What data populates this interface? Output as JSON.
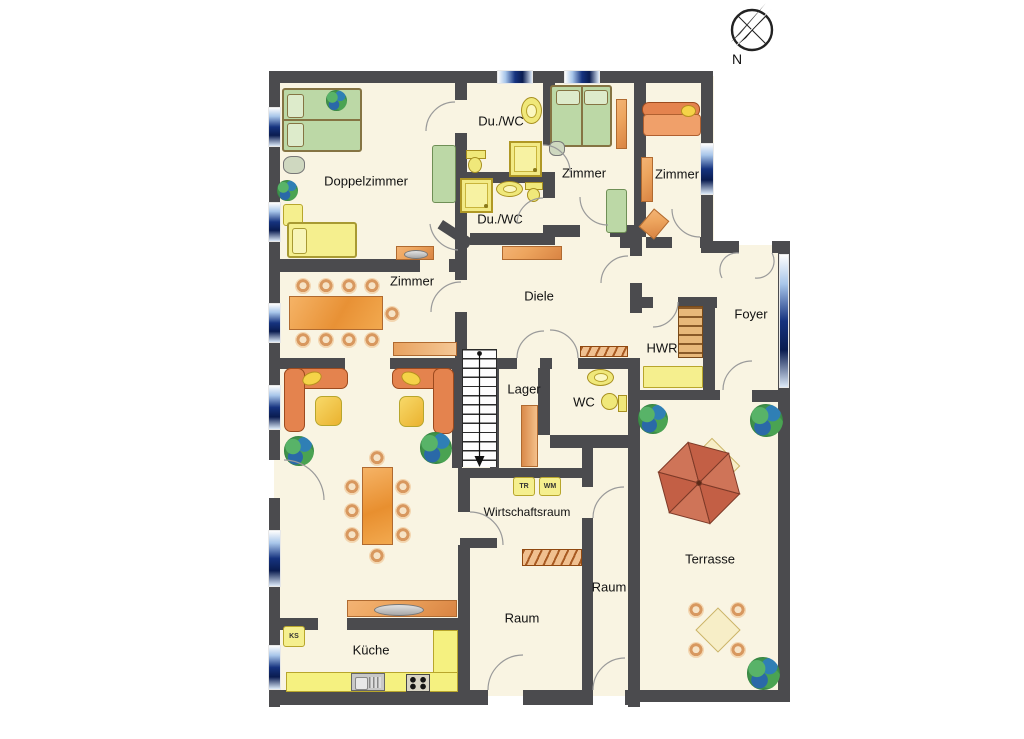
{
  "compass": {
    "label": "N"
  },
  "colors": {
    "wall": "#4b4b4e",
    "floor": "#f9f4e2",
    "windark": "#16337f",
    "orangef": "#eda55e",
    "orangeb": "#b06a30",
    "yellowf": "#f5ef8e",
    "greenf": "#bcd8a6",
    "sofa": "#e4834e",
    "umb1": "#c35f45",
    "umb2": "#cf7458"
  },
  "rooms": {
    "doppelzimmer": {
      "label": "Doppelzimmer"
    },
    "du_wc_top": {
      "label": "Du./WC"
    },
    "du_wc_bottom": {
      "label": "Du./WC"
    },
    "zimmer_mitte": {
      "label": "Zimmer"
    },
    "zimmer_rechts": {
      "label": "Zimmer"
    },
    "zimmer_ess": {
      "label": "Zimmer"
    },
    "diele": {
      "label": "Diele"
    },
    "foyer": {
      "label": "Foyer"
    },
    "hwr": {
      "label": "HWR"
    },
    "lager": {
      "label": "Lager"
    },
    "wc": {
      "label": "WC"
    },
    "wirtschaftsraum": {
      "label": "Wirtschaftsraum"
    },
    "raum_links": {
      "label": "Raum"
    },
    "raum_schmal": {
      "label": "Raum"
    },
    "terrasse": {
      "label": "Terrasse"
    },
    "kueche": {
      "label": "Küche"
    }
  },
  "appliances": {
    "ks": {
      "label": "KS"
    },
    "tr": {
      "label": "TR"
    },
    "wm": {
      "label": "WM"
    }
  }
}
